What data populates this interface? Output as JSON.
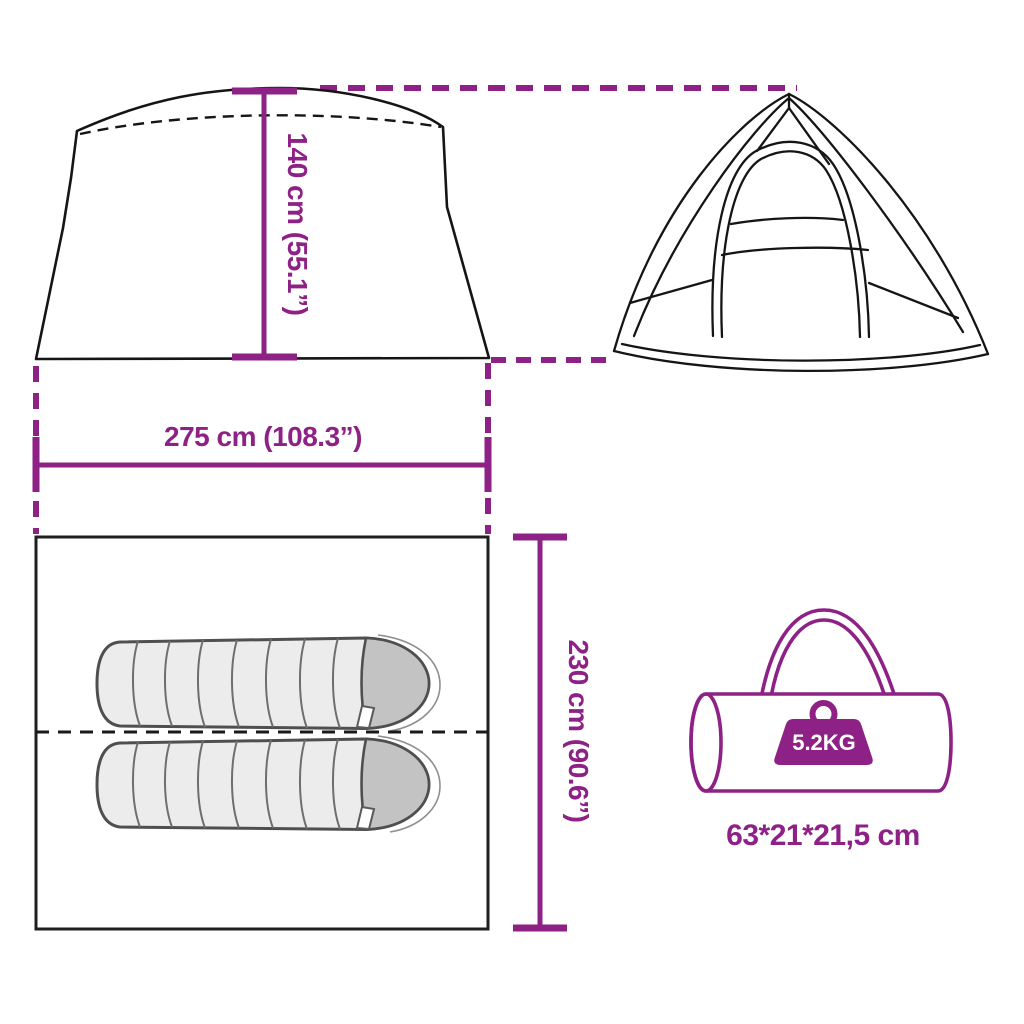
{
  "figure": {
    "type": "product-dimensions-diagram",
    "product": "camping tent with two sleeping places and carry bag"
  },
  "colors": {
    "accent": "#8E2185",
    "line_black": "#1A1A1A",
    "bag_fill": "#ECECEC",
    "bag_hood": "#C3C3C3",
    "badge_text": "#FFFFFF"
  },
  "dimensions": {
    "height": {
      "label": "140 cm (55.1”)"
    },
    "width": {
      "label": "275 cm (108.3”)"
    },
    "depth": {
      "label": "230 cm (90.6”)"
    }
  },
  "carry_bag": {
    "weight_label": "5.2KG",
    "size_label": "63*21*21,5 cm"
  },
  "icons": {
    "weight_icon": "kettlebell-weight-badge",
    "tent_front_icon": "tent-front-silhouette",
    "tent_side_icon": "dome-tent-line-drawing",
    "sleeping_bag_icon": "sleeping-bag-top-view",
    "carry_bag_icon": "duffel-carry-bag-outline"
  }
}
